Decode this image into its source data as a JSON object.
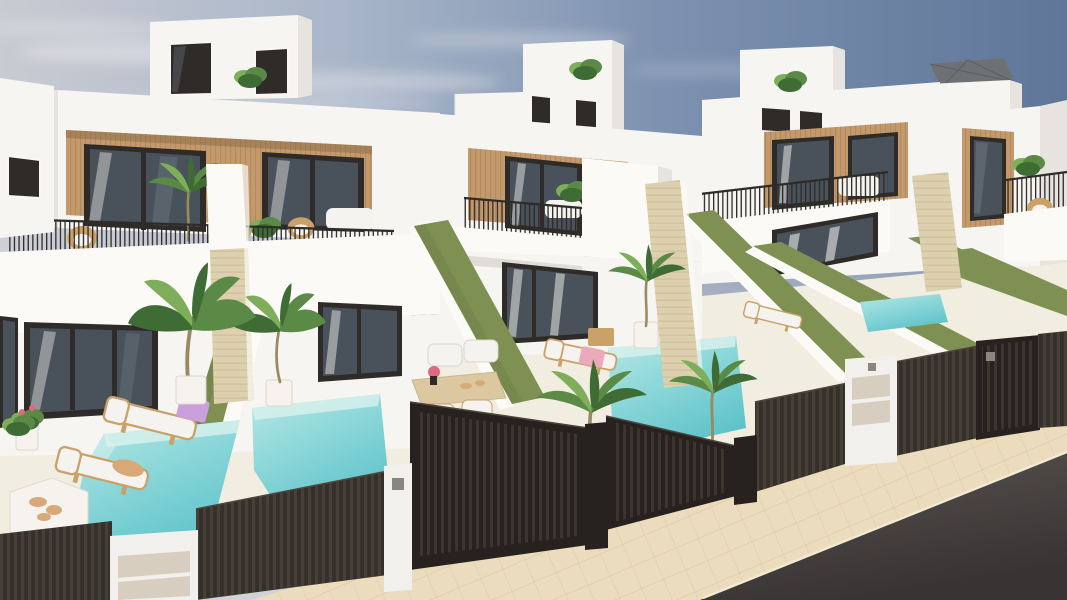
{
  "scene": {
    "description": "Aerial 3D architectural render of a row of modern two-storey white villas, each with a wood-slat facade panel, roof access box, balcony with dark metal railing, travertine pillar, private turquoise plunge pool, green hedge dividing walls, dark slatted street fence with driveway gates, a beige paver sidewalk and a dark asphalt road in the foreground",
    "time_of_day": "daytime, clear sky with thin clouds",
    "environment": {
      "sky": "pale grey-blue on the left grading to deeper blue on the right",
      "horizon": "green grass field visible at the far right",
      "street": {
        "sidewalk": "light beige pavers",
        "road": "dark grey asphalt"
      }
    },
    "buildings": {
      "count_visible": 5,
      "style": "modern Mediterranean new-build townhouses, white render",
      "shared_features": [
        "rooftop stair access box with slit windows",
        "roof terrace shrub",
        "wood-slat accent panel around upper glass sliders",
        "balcony with thin dark railing and white parapet",
        "beige travertine chimney pillar",
        "ground floor glass sliding doors",
        "private pool and terrace"
      ],
      "far_right_roof_terrace": [
        "cantilever parasol",
        "wicker chair",
        "plant"
      ]
    },
    "pools": {
      "count_visible": 4,
      "water": "turquoise with pale submerged walls"
    },
    "landscaping": {
      "hedges": "olive-green hedge walls separating each plot",
      "plants": [
        "banana plant",
        "potted palms",
        "balcony palms",
        "small shrubs with pink flowers"
      ]
    },
    "street_front": {
      "fence": "dark brown vertical-slat aluminium fence",
      "gates": 3,
      "pillars": [
        "white pillar with mailbox panels",
        "white gate pillar with keypad",
        "dark gate posts",
        "white utility pillar with meter doors"
      ]
    },
    "furniture": {
      "left_terrace": [
        "two wooden sun loungers with white cushions",
        "purple towel",
        "white hexagonal low table with shells",
        "potted flowering plant"
      ],
      "center_terrace": [
        "white dining table with light-wood legs",
        "two cushioned chairs",
        "two-seat cushion bench",
        "pink flower centerpiece"
      ],
      "right_terrace": [
        "wooden sun lounger with white cushion and pink towel",
        "small wooden side table"
      ],
      "far_plot": [
        "white sun lounger"
      ]
    }
  },
  "colors": {
    "sky_left": "#c9cbd2",
    "sky_mid1": "#a9b6c9",
    "sky_mid2": "#7d92b0",
    "sky_right": "#5f7699",
    "cloud": "#e6e5e8",
    "grass": "#8a9a50",
    "wall_white": "#f6f5f2",
    "wall_bright": "#fbfaf7",
    "wall_shade": "#e7e4df",
    "wall_dark": "#d8d4ce",
    "wall_shadow": "#c6c2ba",
    "ground": "#f2ede1",
    "wood": "#c49a6c",
    "wood_dark": "#a8825a",
    "frame_dark": "#2e2b28",
    "glass": "#49525a",
    "glass_light": "#68747c",
    "curtain": "#e9e7e3",
    "travertine": "#ddd0ae",
    "travertine_line": "#c9b992",
    "hedge": "#7e9052",
    "hedge_dark": "#6c7d45",
    "pool_light": "#b7e7e5",
    "pool_mid": "#8ad6d8",
    "pool_deep": "#5fc3c9",
    "pool_wall": "#d9f1ec",
    "fence": "#35302b",
    "fence_light": "#4d453d",
    "fence_frame": "#27221f",
    "pillar_white": "#f2f0ec",
    "pillar_panel": "#d8cec0",
    "sidewalk": "#eadcbd",
    "sidewalk_line": "#d8c5a0",
    "road_top": "#5a5553",
    "road_deep": "#383433",
    "furn_wood": "#c9a169",
    "cushion": "#f5f3ef",
    "towel_pink": "#eba9bc",
    "towel_purple": "#c9a0dc",
    "flower_pink": "#e06880",
    "metal": "#8a857e",
    "plant_green": "#5a8a46",
    "plant_dark": "#3f6b34",
    "plant_light": "#7fae5b",
    "parasol": "#6e7174",
    "table_wood": "#dcc8a0",
    "shell": "#d9a877",
    "vase_white": "#f6f3ee",
    "trunk": "#9a8a62"
  }
}
